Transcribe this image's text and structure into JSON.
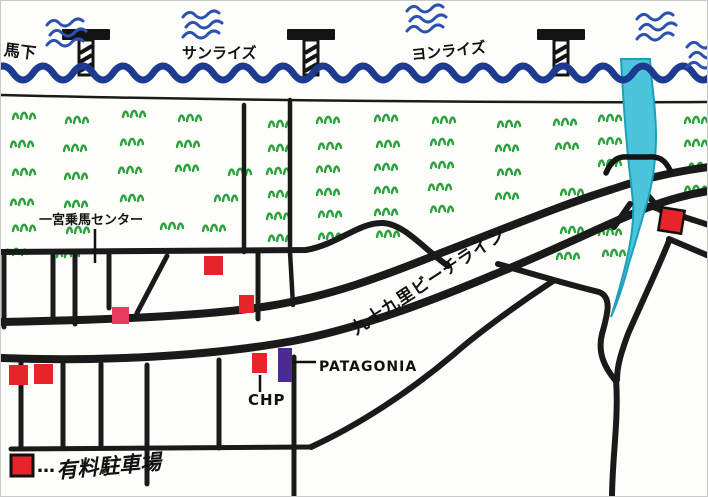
{
  "image_type": "hand-drawn beach town map",
  "colors": {
    "paper": "#fdfdfa",
    "sea_wave": "#1c3b90",
    "water_squiggle": "#2b52b0",
    "river_fill": "#4cc5da",
    "river_edge": "#1b9fbc",
    "grass": "#2ca13f",
    "road": "#1a1a1a",
    "building_red": "#e8242b",
    "building_pink": "#e93a5f",
    "building_purple": "#4b2b92"
  },
  "labels": {
    "place_top_left": "馬下",
    "beach_sunrise": "サンライズ",
    "beach_yonrise": "ヨンライズ",
    "riding_center": "一宮乗馬センター",
    "beach_line_road": "九十九里ビーチライン",
    "patagonia_store": "PATAGONIA",
    "chp_shop": "CHP"
  },
  "legend": {
    "symbol": "red-square",
    "dots": "…",
    "label": "有料駐車場"
  },
  "map": {
    "piers_x": [
      85,
      310,
      560
    ],
    "wave_squiggles": [
      [
        46,
        24
      ],
      [
        182,
        16
      ],
      [
        406,
        10
      ],
      [
        636,
        18
      ],
      [
        686,
        46
      ]
    ],
    "grass_tufts": [
      [
        12,
        110
      ],
      [
        65,
        114
      ],
      [
        122,
        108
      ],
      [
        178,
        112
      ],
      [
        10,
        138
      ],
      [
        63,
        142
      ],
      [
        120,
        136
      ],
      [
        176,
        138
      ],
      [
        12,
        166
      ],
      [
        64,
        170
      ],
      [
        118,
        164
      ],
      [
        175,
        162
      ],
      [
        228,
        166
      ],
      [
        10,
        196
      ],
      [
        64,
        198
      ],
      [
        120,
        192
      ],
      [
        214,
        192
      ],
      [
        12,
        222
      ],
      [
        66,
        224
      ],
      [
        160,
        220
      ],
      [
        202,
        222
      ],
      [
        4,
        246
      ],
      [
        56,
        248
      ],
      [
        268,
        118
      ],
      [
        316,
        114
      ],
      [
        374,
        112
      ],
      [
        432,
        114
      ],
      [
        268,
        142
      ],
      [
        318,
        140
      ],
      [
        376,
        138
      ],
      [
        430,
        136
      ],
      [
        266,
        165
      ],
      [
        316,
        163
      ],
      [
        374,
        161
      ],
      [
        430,
        159
      ],
      [
        268,
        188
      ],
      [
        316,
        186
      ],
      [
        374,
        184
      ],
      [
        428,
        181
      ],
      [
        266,
        210
      ],
      [
        318,
        208
      ],
      [
        374,
        206
      ],
      [
        430,
        203
      ],
      [
        268,
        232
      ],
      [
        318,
        230
      ],
      [
        376,
        228
      ],
      [
        497,
        118
      ],
      [
        553,
        116
      ],
      [
        598,
        112
      ],
      [
        684,
        114
      ],
      [
        495,
        142
      ],
      [
        555,
        140
      ],
      [
        598,
        135
      ],
      [
        684,
        137
      ],
      [
        497,
        166
      ],
      [
        598,
        157
      ],
      [
        688,
        160
      ],
      [
        495,
        190
      ],
      [
        560,
        186
      ],
      [
        684,
        183
      ],
      [
        560,
        224
      ],
      [
        598,
        226
      ],
      [
        556,
        250
      ],
      [
        602,
        247
      ]
    ],
    "red_buildings": [
      [
        203,
        255,
        19,
        19,
        0,
        0
      ],
      [
        238,
        294,
        15,
        18,
        0,
        0
      ],
      [
        8,
        364,
        19,
        20,
        0,
        0
      ],
      [
        33,
        363,
        19,
        20,
        0,
        0
      ],
      [
        251,
        352,
        15,
        20,
        0,
        0
      ],
      [
        659,
        208,
        23,
        23,
        9,
        1
      ]
    ],
    "pink_building": [
      111,
      306,
      17,
      17
    ],
    "purple_building": [
      277,
      347,
      14,
      34
    ],
    "legend_square": [
      10,
      454,
      22,
      21
    ]
  }
}
